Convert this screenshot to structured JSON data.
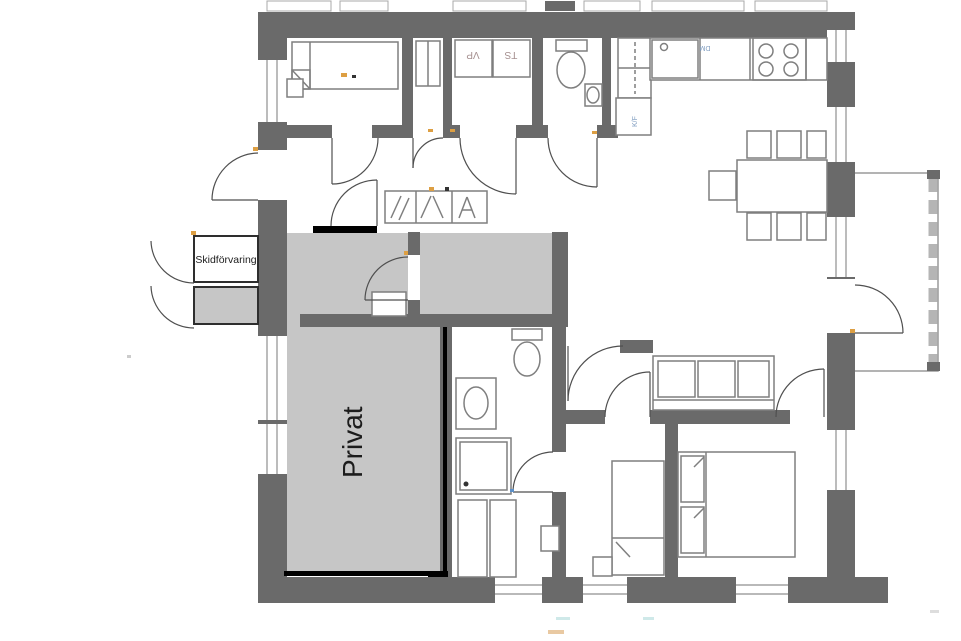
{
  "labels": {
    "ski_storage": "Skidförvaring",
    "private": "Privat",
    "heat_pump": "VP",
    "drying_cabinet": "TS",
    "fridge_freezer": "K/F",
    "dishwasher": "DM"
  },
  "colors": {
    "wall": "#6a6a6a",
    "private_fill": "#c6c6c6",
    "black_border": "#000000",
    "fixture_outline": "#7f7f7f",
    "accent_orange": "#dd9f43",
    "label_blue": "#7d9bbf",
    "label_red_gray": "#a58f8f"
  }
}
